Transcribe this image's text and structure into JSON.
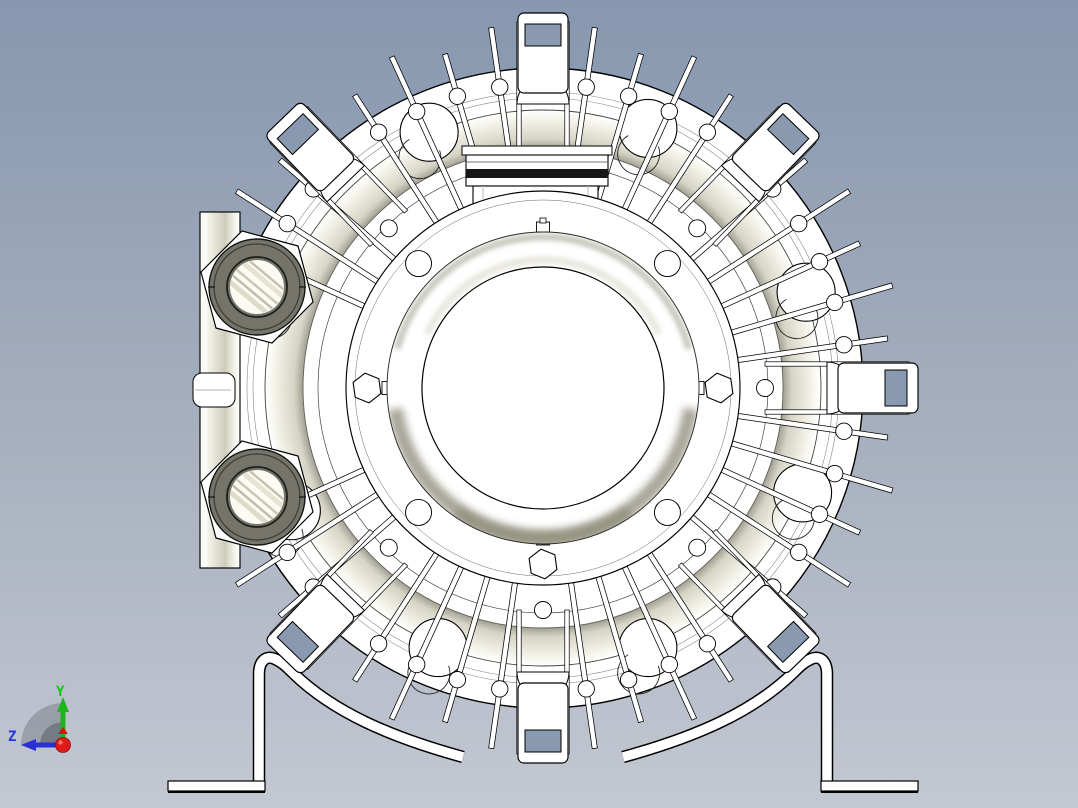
{
  "viewport": {
    "width": 1078,
    "height": 808,
    "background_top": "#8697af",
    "background_bottom": "#c3c8d2"
  },
  "triad": {
    "y_label": "Y",
    "z_label": "Z",
    "y_color": "#1db41d",
    "z_color": "#2a2fd6",
    "x_color": "#e01a1a",
    "shadow_color": "#70747e",
    "origin": [
      63,
      745
    ]
  },
  "model": {
    "name": "side-channel-blower-front-view",
    "center": [
      543,
      388
    ],
    "fill": "#ffffff",
    "outline": "#000000",
    "radii": {
      "inner_face": 121,
      "dome": 156,
      "flange": 197,
      "flange_inner_line": 188,
      "step_circle": 225,
      "band_inner": 240,
      "band_outer": 278,
      "rim_line1": 290,
      "rim_line2": 296,
      "rim_outer": 320,
      "boss_ring": 304,
      "axis_boss_ring": 222,
      "bolt_ring": 176,
      "large_ring": 280,
      "large_ring_r": 29,
      "large_ring_inner_r": 21,
      "spike_tip_long": 364,
      "spike_tip_short": 348,
      "tab_tip": 375
    },
    "shading": {
      "band_dark": "#8e8d81",
      "band_mid": "#d6d4c4",
      "band_light": "#f4f3ea",
      "dome_shadow": "#a8a699",
      "dome_shadow_deep": "#94927f",
      "dome_top_shadow": "#c2c2b8",
      "plate_mid": "#cfccba"
    },
    "spikes": {
      "count": 44,
      "skip_near_tab_deg": 3.2,
      "blocked_arc_deg": [
        161,
        199
      ]
    },
    "tab_angles_deg": [
      0,
      46,
      90,
      134,
      226,
      270,
      314
    ],
    "large_ring_angles_deg": [
      20,
      68,
      114,
      160,
      206,
      248,
      292,
      338
    ],
    "flange_bolts": {
      "hex_angles_deg": [
        0,
        180,
        270
      ],
      "hole_angles_deg": [
        45,
        135,
        225,
        315
      ],
      "stud_angles_deg": [
        90
      ],
      "hole_r": 13,
      "hex_r": 15
    },
    "ports": {
      "plate": {
        "x": 200,
        "y": 212,
        "w": 40,
        "h": 356
      },
      "side_tab": {
        "x": 193,
        "y": 373,
        "w": 42,
        "h": 34
      },
      "centers": [
        [
          257,
          287
        ],
        [
          257,
          497
        ]
      ],
      "boss_r": 58,
      "ring_outer_r": 48,
      "ring_inner_r": 30,
      "bore_r": 27,
      "ring_color": "#74746b",
      "ring_edge": "#15150f",
      "bore_color": "#fcfbf3"
    },
    "top_block": {
      "ledge": [
        462,
        146,
        150,
        9
      ],
      "main": [
        466,
        155,
        142,
        31
      ],
      "dark_band": [
        466,
        169,
        142,
        9
      ],
      "dark_color": "#161616",
      "lower": [
        473,
        186,
        125,
        30
      ]
    },
    "feet": {
      "base": [
        168,
        781,
        97,
        10
      ],
      "leg_x": 259,
      "strap_width": 9.5,
      "strap_path": "M 259,783 L 259,674 C 259,661 266,655 275,659 C 282,662 287,667 293,673 C 333,712 390,737 463,757"
    }
  }
}
